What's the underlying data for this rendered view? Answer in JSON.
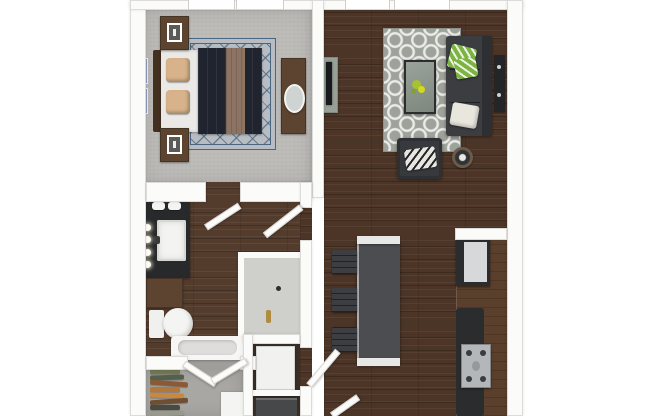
{
  "scene": {
    "type": "apartment-floor-plan-3d-top-view",
    "rooms": [
      "bedroom",
      "living-room",
      "kitchen",
      "bathroom",
      "hallway",
      "walk-in-closet",
      "utility-closet",
      "entry"
    ]
  },
  "palette": {
    "bg": "#ffffff",
    "wall": "#fbfbf9",
    "wall_edge": "#dcdbd8",
    "wood": "#4c3527",
    "carpet": "#bab9b6",
    "carpet_closet": "#a9a7a3",
    "rug_bedroom": "#b7bdc2",
    "rug_living": "#9da29a",
    "bed_sheet": "#eae9e6",
    "bed_duvet": "#20242e",
    "bed_throw": "#8d7362",
    "pillow_tan": "#d7b28a",
    "furniture_wood": "#5c4430",
    "furniture_wood_dark": "#43301f",
    "sofa": "#3b3d40",
    "pillow_green": "#7cb342",
    "pillow_white": "#e9e6de",
    "tv": "#17191c",
    "console": "#98a198",
    "island": "#4b4d50",
    "island_cap": "#e7e7e5",
    "stool": "#3c3e41",
    "counter_wood": "#5a3f2c",
    "counter_dark": "#2a2c2e",
    "steel": "#b4b7b9",
    "fridge": "#2a2c2e",
    "fridge_panel": "#d7d8d9",
    "vanity": "#28292b",
    "fixture_white": "#f3f3f1",
    "gold": "#b08c3e",
    "shower_floor": "#cfcfcc",
    "water_heater": "#f1f1ef",
    "appliance": "#46484a"
  },
  "bedroom": {
    "furniture": [
      "bed-queen",
      "nightstand",
      "nightstand",
      "dresser-with-oval-mirror",
      "diamond-lattice-rug",
      "wall-art"
    ],
    "window_count": 2
  },
  "living_room": {
    "furniture": [
      "sofa",
      "armchair",
      "glass-coffee-table",
      "round-side-table",
      "tv-console",
      "tv",
      "quatrefoil-rug",
      "wall-console"
    ],
    "window_count": 2
  },
  "kitchen": {
    "furniture": [
      "island",
      "counter-run"
    ],
    "stool_count": 3,
    "appliances": [
      "refrigerator",
      "range"
    ]
  },
  "bathroom": {
    "fixtures": [
      "vanity-with-sink",
      "storage-cabinet",
      "toilet",
      "walk-in-shower",
      "bathtub"
    ],
    "vanity_light_count": 4
  },
  "closet": {
    "items": [
      "hanging-clothes",
      "storage-box"
    ],
    "clothes_colors": [
      "#6f7750",
      "#55604a",
      "#8a5a36",
      "#b5763b",
      "#c9883f",
      "#6e4f33",
      "#494a42",
      "#97998c",
      "#7a6a4e"
    ]
  },
  "utility": {
    "items": [
      "water-heater",
      "washer-dryer"
    ]
  },
  "doors": [
    "bedroom-door",
    "hallway-door",
    "closet-double-door-left",
    "closet-double-door-right",
    "utility-entry-door",
    "entry-door"
  ]
}
